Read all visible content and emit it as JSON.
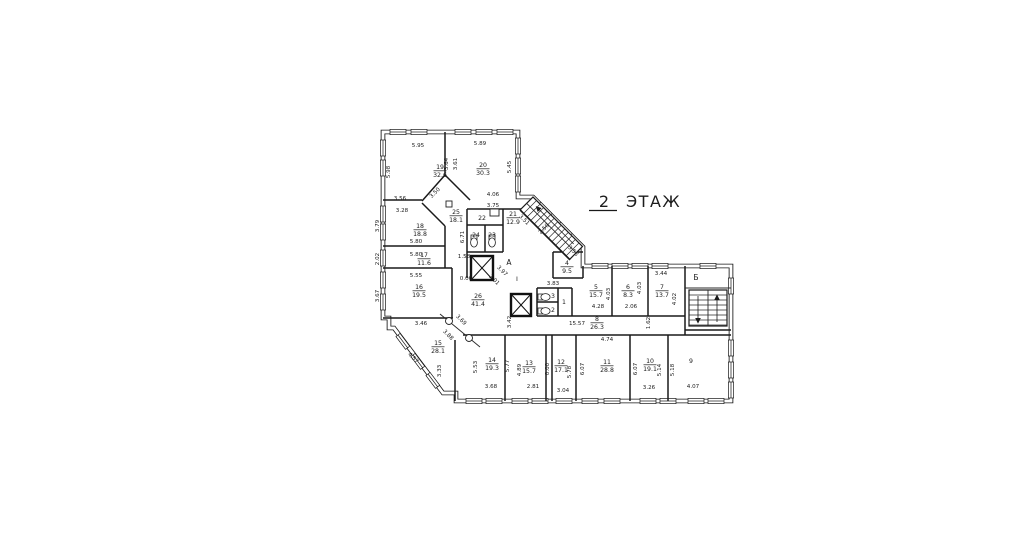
{
  "title": {
    "floor_number": "2",
    "floor_word": "ЭТАЖ"
  },
  "plan": {
    "stairwell_markers": [
      {
        "text": "А",
        "x": 509,
        "y": 265,
        "size": 7.5
      },
      {
        "text": "I",
        "x": 517,
        "y": 281,
        "size": 6.5
      },
      {
        "text": "Б",
        "x": 696,
        "y": 280,
        "size": 7.5
      }
    ],
    "rooms": [
      {
        "number": "19",
        "area": "32.6",
        "x": 440,
        "y": 169
      },
      {
        "number": "20",
        "area": "30.3",
        "x": 483,
        "y": 167
      },
      {
        "number": "25",
        "area": "18.1",
        "x": 456,
        "y": 214
      },
      {
        "number": "21",
        "area": "12.9",
        "x": 513,
        "y": 216
      },
      {
        "number": "22",
        "area": "",
        "x": 482,
        "y": 220
      },
      {
        "number": "24",
        "area": "",
        "x": 476,
        "y": 237
      },
      {
        "number": "23",
        "area": "",
        "x": 492,
        "y": 237
      },
      {
        "number": "18",
        "area": "18.8",
        "x": 420,
        "y": 228
      },
      {
        "number": "17",
        "area": "11.6",
        "x": 424,
        "y": 257
      },
      {
        "number": "16",
        "area": "19.5",
        "x": 419,
        "y": 289
      },
      {
        "number": "26",
        "area": "41.4",
        "x": 478,
        "y": 298
      },
      {
        "number": "15",
        "area": "28.1",
        "x": 438,
        "y": 345
      },
      {
        "number": "14",
        "area": "19.3",
        "x": 492,
        "y": 362
      },
      {
        "number": "13",
        "area": "15.7",
        "x": 529,
        "y": 365
      },
      {
        "number": "12",
        "area": "17.1",
        "x": 561,
        "y": 364
      },
      {
        "number": "11",
        "area": "28.8",
        "x": 607,
        "y": 364
      },
      {
        "number": "10",
        "area": "19.1",
        "x": 650,
        "y": 363
      },
      {
        "number": "9",
        "area": "",
        "x": 691,
        "y": 363
      },
      {
        "number": "8",
        "area": "26.3",
        "x": 597,
        "y": 321
      },
      {
        "number": "5",
        "area": "15.7",
        "x": 596,
        "y": 289
      },
      {
        "number": "6",
        "area": "8.3",
        "x": 628,
        "y": 289
      },
      {
        "number": "7",
        "area": "13.7",
        "x": 662,
        "y": 289
      },
      {
        "number": "4",
        "area": "9.5",
        "x": 567,
        "y": 265
      },
      {
        "number": "3",
        "area": "",
        "x": 553,
        "y": 298
      },
      {
        "number": "2",
        "area": "",
        "x": 553,
        "y": 312
      },
      {
        "number": "1",
        "area": "",
        "x": 564,
        "y": 304
      }
    ],
    "dimensions": [
      {
        "text": "5.95",
        "x": 418,
        "y": 147,
        "rot": 0
      },
      {
        "text": "5.89",
        "x": 480,
        "y": 145,
        "rot": 0
      },
      {
        "text": "5.98",
        "x": 390,
        "y": 172,
        "rot": 270
      },
      {
        "text": "3.64",
        "x": 448,
        "y": 164,
        "rot": 270
      },
      {
        "text": "3.61",
        "x": 457,
        "y": 164,
        "rot": 270
      },
      {
        "text": "5.45",
        "x": 511,
        "y": 167,
        "rot": 270
      },
      {
        "text": "3.56",
        "x": 400,
        "y": 200,
        "rot": 0
      },
      {
        "text": "3.28",
        "x": 402,
        "y": 212,
        "rot": 0
      },
      {
        "text": "3.50",
        "x": 436,
        "y": 194,
        "rot": 315
      },
      {
        "text": "4.06",
        "x": 493,
        "y": 196,
        "rot": 0
      },
      {
        "text": "3.75",
        "x": 493,
        "y": 207,
        "rot": 0
      },
      {
        "text": "3.79",
        "x": 379,
        "y": 226,
        "rot": 270
      },
      {
        "text": "6.71",
        "x": 464,
        "y": 237,
        "rot": 270
      },
      {
        "text": "3.51",
        "x": 523,
        "y": 221,
        "rot": 45
      },
      {
        "text": "2.50",
        "x": 545,
        "y": 230,
        "rot": 315
      },
      {
        "text": "3.58",
        "x": 572,
        "y": 252,
        "rot": 45
      },
      {
        "text": "5.80",
        "x": 416,
        "y": 243,
        "rot": 0
      },
      {
        "text": "5.80",
        "x": 416,
        "y": 256,
        "rot": 0
      },
      {
        "text": "2.02",
        "x": 379,
        "y": 259,
        "rot": 270
      },
      {
        "text": "1.58",
        "x": 464,
        "y": 258,
        "rot": 0
      },
      {
        "text": "0.00",
        "x": 466,
        "y": 280,
        "rot": 0
      },
      {
        "text": "3.97",
        "x": 501,
        "y": 272,
        "rot": 45
      },
      {
        "text": "3.01",
        "x": 493,
        "y": 281,
        "rot": 45
      },
      {
        "text": "5.55",
        "x": 416,
        "y": 277,
        "rot": 0
      },
      {
        "text": "3.67",
        "x": 379,
        "y": 296,
        "rot": 270
      },
      {
        "text": "3.83",
        "x": 553,
        "y": 285,
        "rot": 0
      },
      {
        "text": "3.44",
        "x": 661,
        "y": 275,
        "rot": 0
      },
      {
        "text": "4.03",
        "x": 610,
        "y": 294,
        "rot": 270
      },
      {
        "text": "4.03",
        "x": 641,
        "y": 288,
        "rot": 270
      },
      {
        "text": "4.02",
        "x": 676,
        "y": 299,
        "rot": 270
      },
      {
        "text": "4.28",
        "x": 598,
        "y": 308,
        "rot": 0
      },
      {
        "text": "2.06",
        "x": 631,
        "y": 308,
        "rot": 0
      },
      {
        "text": "15.57",
        "x": 577,
        "y": 325,
        "rot": 0
      },
      {
        "text": "1.62",
        "x": 650,
        "y": 323,
        "rot": 270
      },
      {
        "text": "4.74",
        "x": 607,
        "y": 341,
        "rot": 0
      },
      {
        "text": "3.46",
        "x": 421,
        "y": 325,
        "rot": 0
      },
      {
        "text": "3.42",
        "x": 511,
        "y": 322,
        "rot": 270
      },
      {
        "text": "3.69",
        "x": 460,
        "y": 321,
        "rot": 45
      },
      {
        "text": "3.88",
        "x": 447,
        "y": 336,
        "rot": 45
      },
      {
        "text": "4.57",
        "x": 412,
        "y": 359,
        "rot": 45
      },
      {
        "text": "3.33",
        "x": 441,
        "y": 371,
        "rot": 270
      },
      {
        "text": "5.53",
        "x": 477,
        "y": 367,
        "rot": 270
      },
      {
        "text": "5.77",
        "x": 509,
        "y": 366,
        "rot": 270
      },
      {
        "text": "4.89",
        "x": 521,
        "y": 370,
        "rot": 270
      },
      {
        "text": "0.00",
        "x": 549,
        "y": 369,
        "rot": 270
      },
      {
        "text": "5.78",
        "x": 571,
        "y": 372,
        "rot": 270
      },
      {
        "text": "6.07",
        "x": 584,
        "y": 369,
        "rot": 270
      },
      {
        "text": "6.07",
        "x": 637,
        "y": 369,
        "rot": 270
      },
      {
        "text": "5.14",
        "x": 661,
        "y": 370,
        "rot": 270
      },
      {
        "text": "5.18",
        "x": 674,
        "y": 370,
        "rot": 270
      },
      {
        "text": "3.68",
        "x": 491,
        "y": 388,
        "rot": 0
      },
      {
        "text": "2.81",
        "x": 533,
        "y": 388,
        "rot": 0
      },
      {
        "text": "3.04",
        "x": 563,
        "y": 392,
        "rot": 0
      },
      {
        "text": "3.26",
        "x": 649,
        "y": 389,
        "rot": 0
      },
      {
        "text": "4.07",
        "x": 693,
        "y": 388,
        "rot": 0
      }
    ]
  }
}
